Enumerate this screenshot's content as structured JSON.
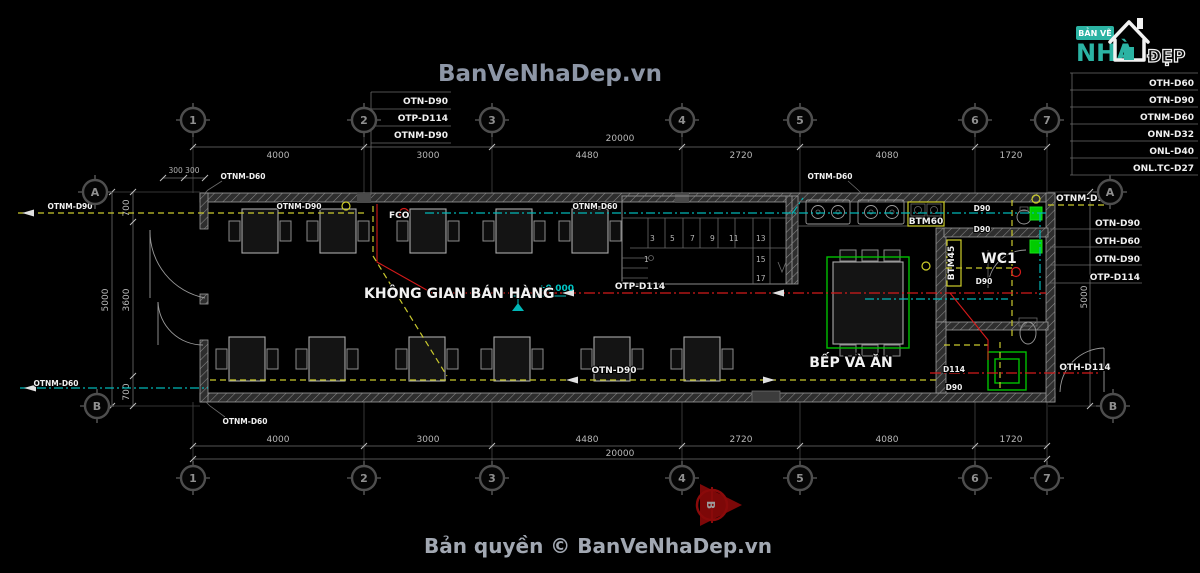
{
  "page": {
    "title": "BanVeNhaDep.vn",
    "copyright": "Bản quyền © BanVeNhaDep.vn"
  },
  "logo": {
    "line1": "BẢN VẼ",
    "line2": "NHÀ",
    "line3": "ĐẸP"
  },
  "legend": {
    "rows": [
      "OTH-D60",
      "OTN-D90",
      "OTNM-D60",
      "ONN-D32",
      "ONL-D40",
      "ONL.TC-D27"
    ]
  },
  "grid": {
    "cols": [
      "1",
      "2",
      "3",
      "4",
      "5",
      "6",
      "7"
    ],
    "rows": [
      "A",
      "B"
    ]
  },
  "dims": {
    "top_segments": [
      "4000",
      "3000",
      "4480",
      "2720",
      "4080",
      "1720"
    ],
    "top_total": "20000",
    "bottom_segments": [
      "4000",
      "3000",
      "4480",
      "2720",
      "4080",
      "1720"
    ],
    "bottom_total": "20000",
    "left_300": "300 300",
    "left_700_top": "700",
    "left_3600": "3600",
    "left_5000": "5000",
    "left_700_bottom": "700",
    "right_5000": "5000"
  },
  "rooms": {
    "sales": "KHÔNG GIAN BÁN HÀNG",
    "kitchen": "BẾP VÀ ĂN",
    "wc": "WC1"
  },
  "level_marker": "±0.000",
  "labels": {
    "stack_top": [
      "OTN-D90",
      "OTP-D114",
      "OTNM-D90"
    ],
    "stack_right": [
      "OTN-D90",
      "OTH-D60",
      "OTN-D90",
      "OTP-D114"
    ],
    "tl_wall": "OTNM-D60",
    "left_a": "OTNM-D90",
    "inner_top": "OTNM-D90",
    "fco": "FCO",
    "mid_top": "OTNM-D60",
    "tr_wall": "OTNM-D60",
    "right_a": "OTNM-D90",
    "center_red": "OTP-D114",
    "bottom_mid": "OTN-D90",
    "left_b": "OTNM-D60",
    "bl_wall": "OTNM-D60",
    "d90_1": "D90",
    "d90_2": "D90",
    "d90_3": "D90",
    "btm60": "BTM60",
    "btm45": "BTM45",
    "d114": "D114",
    "d90_4": "D90",
    "oth_d114": "OTH-D114",
    "section": "B"
  },
  "stairs": {
    "numbers": [
      "1",
      "3",
      "5",
      "7",
      "9",
      "11",
      "13",
      "15",
      "17"
    ]
  },
  "colors": {
    "pipe_yellow": "#c9c92e",
    "pipe_teal": "#00b7b7",
    "pipe_red": "#d41a1a",
    "pipe_green": "#00c000",
    "brand_teal": "#2bb3a3"
  }
}
